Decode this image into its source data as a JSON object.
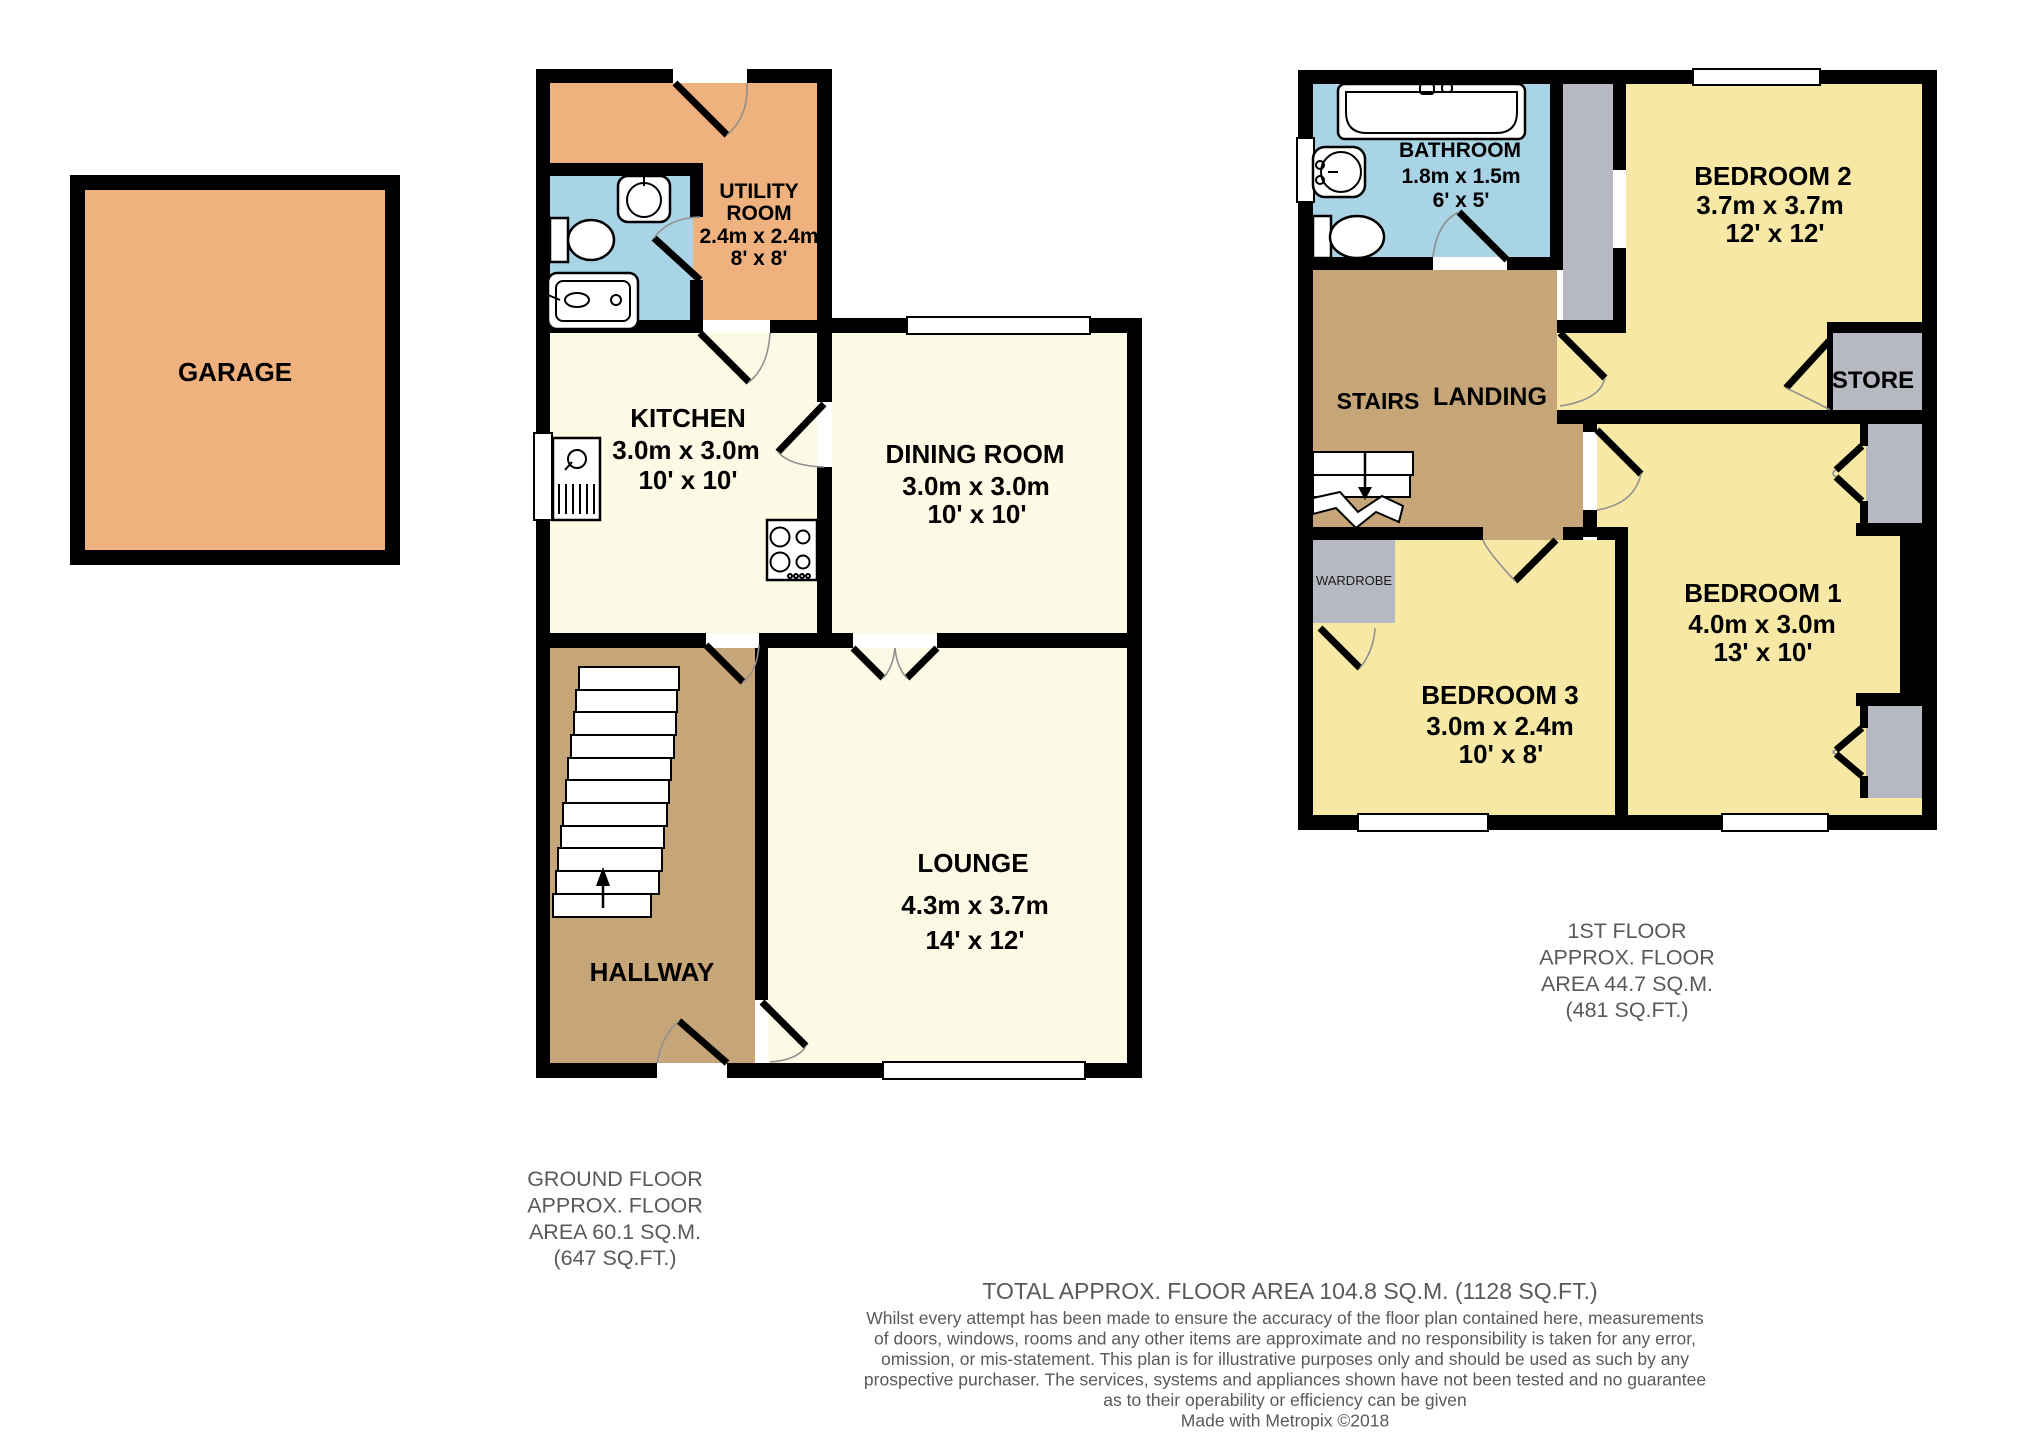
{
  "colors": {
    "wall": "#000000",
    "garage_utility_orange": "#efb17d",
    "bathroom_blue": "#a9d4e6",
    "ground_room_cream": "#fcfae4",
    "bedroom_yellow": "#f8e8a6",
    "hall_landing_brown": "#c6a679",
    "store_gray": "#b7b9c2",
    "caption_gray": "#59595b"
  },
  "ground": {
    "garage": {
      "label": "GARAGE"
    },
    "utility": {
      "lines": [
        "UTILITY",
        "ROOM",
        "2.4m x 2.4m",
        "8' x 8'"
      ]
    },
    "kitchen": {
      "lines": [
        "KITCHEN",
        "3.0m x 3.0m",
        "10' x 10'"
      ]
    },
    "dining": {
      "lines": [
        "DINING ROOM",
        "3.0m x 3.0m",
        "10' x 10'"
      ]
    },
    "lounge": {
      "lines": [
        "LOUNGE",
        "4.3m x 3.7m",
        "14' x 12'"
      ]
    },
    "hallway": {
      "label": "HALLWAY"
    },
    "caption": [
      "GROUND FLOOR",
      "APPROX. FLOOR",
      "AREA 60.1 SQ.M.",
      "(647 SQ.FT.)"
    ]
  },
  "first": {
    "bathroom": {
      "lines": [
        "BATHROOM",
        "1.8m x 1.5m",
        "6' x 5'"
      ]
    },
    "bedroom2": {
      "lines": [
        "BEDROOM 2",
        "3.7m x 3.7m",
        "12' x 12'"
      ]
    },
    "bedroom1": {
      "lines": [
        "BEDROOM 1",
        "4.0m x 3.0m",
        "13' x 10'"
      ]
    },
    "bedroom3": {
      "lines": [
        "BEDROOM 3",
        "3.0m x 2.4m",
        "10' x 8'"
      ]
    },
    "stairs_label": "STAIRS",
    "landing_label": "LANDING",
    "store_label": "STORE",
    "wardrobe_label": "WARDROBE",
    "caption": [
      "1ST FLOOR",
      "APPROX. FLOOR",
      "AREA 44.7 SQ.M.",
      "(481 SQ.FT.)"
    ]
  },
  "footer": {
    "total": "TOTAL APPROX. FLOOR AREA 104.8 SQ.M. (1128 SQ.FT.)",
    "disclaimer": [
      "Whilst every attempt has been made to ensure the accuracy of the floor plan contained here, measurements",
      "of doors, windows, rooms and any other items are approximate and no responsibility is taken for any error,",
      "omission, or mis-statement. This plan is for illustrative purposes only and should be used as such by any",
      "prospective purchaser. The services, systems and appliances shown have not been tested and no guarantee",
      "as to their operability or efficiency can be given"
    ],
    "credit": "Made with Metropix ©2018"
  }
}
